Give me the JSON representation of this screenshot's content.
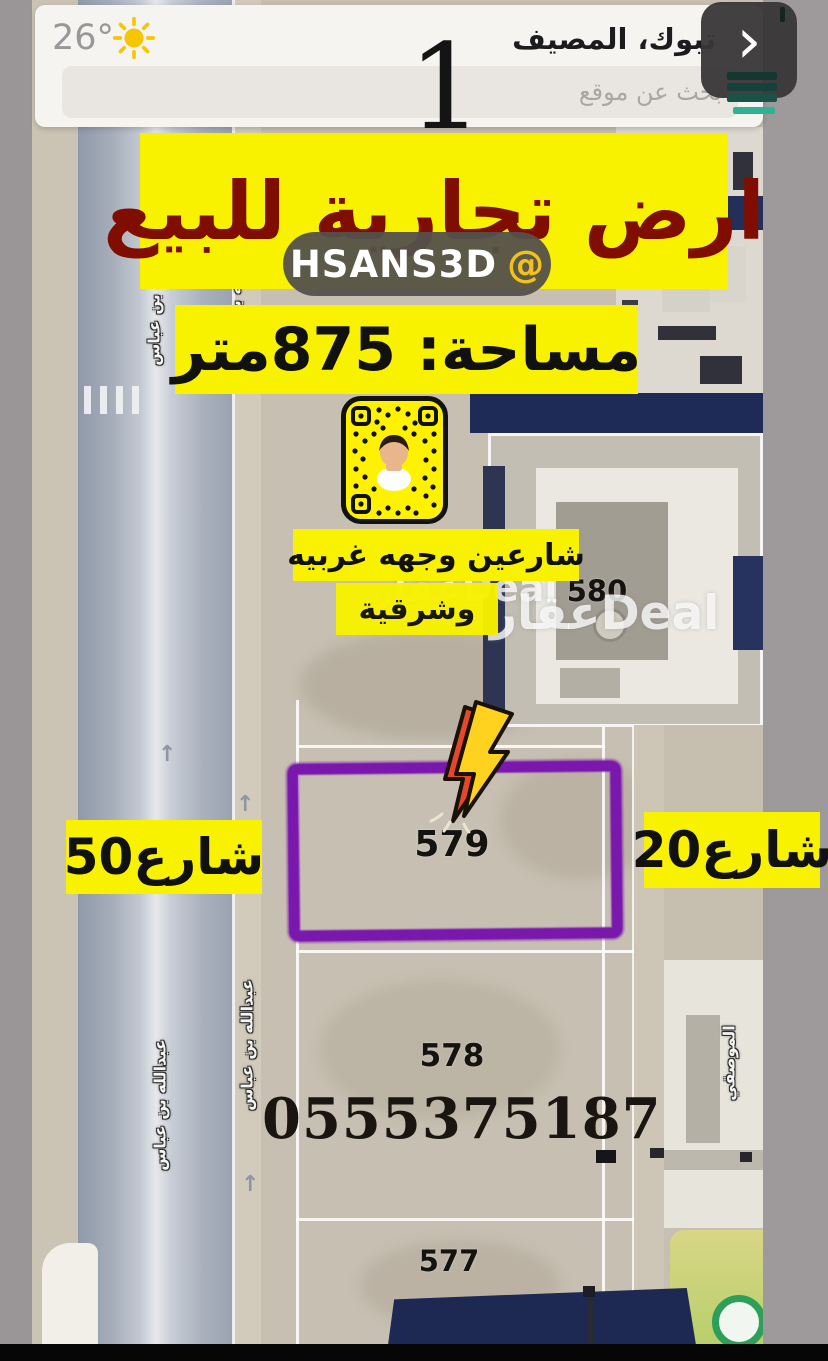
{
  "app": {
    "temperature": "26°",
    "location_title": "تبوك، المصيف",
    "search_placeholder": "بحث عن موقع",
    "overlay_digit": "1",
    "nav_chevron": "›"
  },
  "listing": {
    "title": "ارض تجارية للبيع",
    "snap_username": "HSANS3D",
    "snap_at": "@",
    "area_label": "مساحة: 875متر",
    "frontage_line1": "شارعين وجهه غربيه",
    "frontage_line2": "وشرقية",
    "street_50": "شارع50",
    "street_20": "شارع20",
    "phone": "0555375187",
    "watermark": "عقارDeal"
  },
  "map": {
    "plot_labels": {
      "p452": "452",
      "p580": "580",
      "p579": "579",
      "p578": "578",
      "p577": "577"
    },
    "street_name_vertical": "عبدالله بن عباس",
    "street_name_right": "الموصقي",
    "road_arrow": "↑"
  },
  "colors": {
    "banner_yellow": "#f8f200",
    "title_red": "#7f0e00",
    "highlight_purple": "#7a17ad",
    "accent_teal": "#2fb294",
    "snapcode_yellow": "#fff200",
    "roof_navy": "#1f2b57",
    "logo_green": "#2e9e5b",
    "sun_yellow": "#f7c600"
  }
}
